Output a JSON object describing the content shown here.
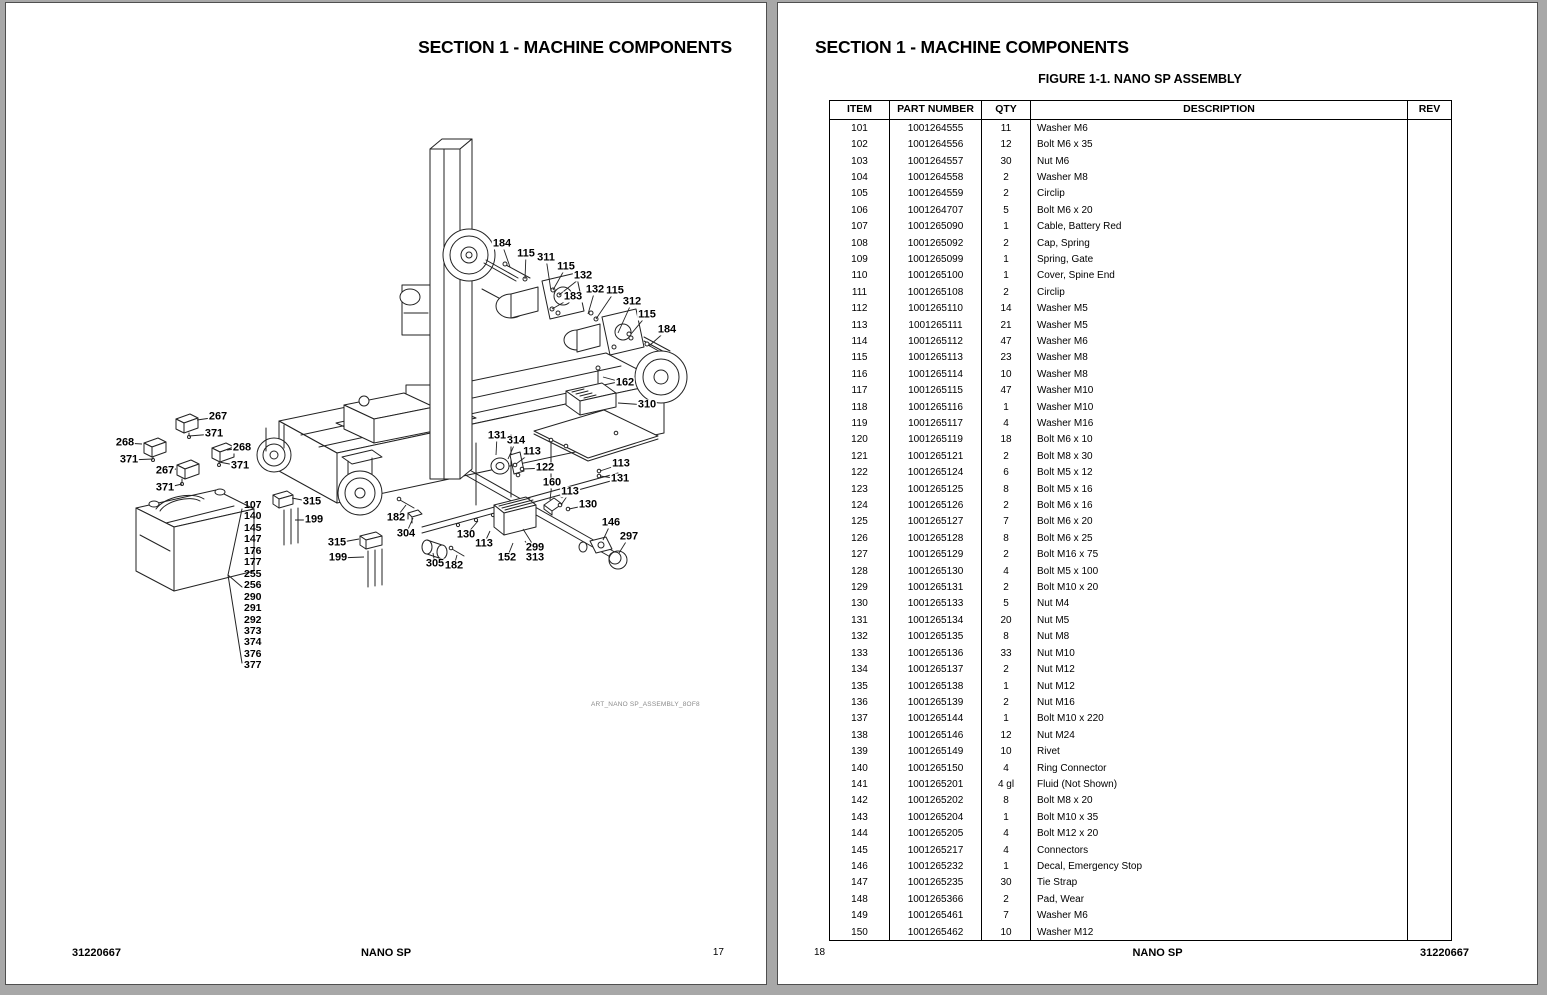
{
  "viewer": {
    "background_color": "#a8a8a8",
    "page_color": "#ffffff"
  },
  "left_page": {
    "section_title": "SECTION 1 - MACHINE COMPONENTS",
    "diagram_caption": "ART_NANO SP_ASSEMBLY_8OF8",
    "footer": {
      "left": "31220667",
      "center": "NANO SP",
      "right": "17"
    },
    "diagram": {
      "callouts": [
        {
          "t": "184",
          "x": 496,
          "y": 241,
          "tx": 504,
          "ty": 264
        },
        {
          "t": "115",
          "x": 520,
          "y": 251,
          "tx": 519,
          "ty": 276
        },
        {
          "t": "311",
          "x": 540,
          "y": 255,
          "tx": 545,
          "ty": 288
        },
        {
          "t": "115",
          "x": 560,
          "y": 264,
          "tx": 547,
          "ty": 287
        },
        {
          "t": "132",
          "x": 577,
          "y": 273,
          "tx": 553,
          "ty": 292
        },
        {
          "t": "183",
          "x": 567,
          "y": 294,
          "tx": 546,
          "ty": 306
        },
        {
          "t": "132",
          "x": 589,
          "y": 287,
          "tx": 582,
          "ty": 311
        },
        {
          "t": "115",
          "x": 609,
          "y": 288,
          "tx": 590,
          "ty": 316
        },
        {
          "t": "312",
          "x": 626,
          "y": 299,
          "tx": 612,
          "ty": 330
        },
        {
          "t": "115",
          "x": 641,
          "y": 312,
          "tx": 625,
          "ty": 331
        },
        {
          "t": "184",
          "x": 661,
          "y": 327,
          "tx": 643,
          "ty": 343
        },
        {
          "t": "162",
          "x": 619,
          "y": 380,
          "tx": 597,
          "ty": 374
        },
        {
          "t": "310",
          "x": 641,
          "y": 402,
          "tx": 612,
          "ty": 400
        },
        {
          "t": "267",
          "x": 212,
          "y": 414,
          "tx": 191,
          "ty": 417
        },
        {
          "t": "371",
          "x": 208,
          "y": 431,
          "tx": 183,
          "ty": 433
        },
        {
          "t": "268",
          "x": 119,
          "y": 440,
          "tx": 136,
          "ty": 441
        },
        {
          "t": "371",
          "x": 123,
          "y": 457,
          "tx": 147,
          "ty": 456
        },
        {
          "t": "268",
          "x": 236,
          "y": 445,
          "tx": 221,
          "ty": 447
        },
        {
          "t": "371",
          "x": 234,
          "y": 463,
          "tx": 213,
          "ty": 459
        },
        {
          "t": "267",
          "x": 159,
          "y": 468,
          "tx": 170,
          "ty": 466
        },
        {
          "t": "371",
          "x": 159,
          "y": 485,
          "tx": 176,
          "ty": 481
        },
        {
          "t": "315",
          "x": 306,
          "y": 499,
          "tx": 286,
          "ty": 495
        },
        {
          "t": "199",
          "x": 308,
          "y": 517,
          "tx": 289,
          "ty": 517
        },
        {
          "t": "182",
          "x": 390,
          "y": 515,
          "tx": 400,
          "ty": 502
        },
        {
          "t": "304",
          "x": 400,
          "y": 531,
          "tx": 407,
          "ty": 515
        },
        {
          "t": "315",
          "x": 331,
          "y": 540,
          "tx": 353,
          "ty": 536
        },
        {
          "t": "199",
          "x": 332,
          "y": 555,
          "tx": 358,
          "ty": 554
        },
        {
          "t": "305",
          "x": 429,
          "y": 561,
          "tx": 427,
          "ty": 550
        },
        {
          "t": "182",
          "x": 448,
          "y": 563,
          "tx": 451,
          "ty": 552
        },
        {
          "t": "130",
          "x": 460,
          "y": 532,
          "tx": 472,
          "ty": 518
        },
        {
          "t": "113",
          "x": 478,
          "y": 541,
          "tx": 484,
          "ty": 528
        },
        {
          "t": "152",
          "x": 501,
          "y": 555,
          "tx": 507,
          "ty": 540
        },
        {
          "t": "299",
          "x": 529,
          "y": 545,
          "tx": 517,
          "ty": 526
        },
        {
          "t": "313",
          "x": 529,
          "y": 555,
          "tx": 519,
          "ty": 538
        },
        {
          "t": "131",
          "x": 491,
          "y": 433,
          "tx": 490,
          "ty": 452
        },
        {
          "t": "314",
          "x": 510,
          "y": 438,
          "tx": 502,
          "ty": 456
        },
        {
          "t": "113",
          "x": 526,
          "y": 449,
          "tx": 510,
          "ty": 461
        },
        {
          "t": "122",
          "x": 539,
          "y": 465,
          "tx": 517,
          "ty": 466
        },
        {
          "t": "113",
          "x": 615,
          "y": 461,
          "tx": 594,
          "ty": 468
        },
        {
          "t": "131",
          "x": 614,
          "y": 476,
          "tx": 594,
          "ty": 473
        },
        {
          "t": "160",
          "x": 546,
          "y": 480,
          "tx": 544,
          "ty": 497
        },
        {
          "t": "113",
          "x": 564,
          "y": 489,
          "tx": 555,
          "ty": 502
        },
        {
          "t": "130",
          "x": 582,
          "y": 502,
          "tx": 563,
          "ty": 506
        },
        {
          "t": "146",
          "x": 605,
          "y": 520,
          "tx": 597,
          "ty": 537
        },
        {
          "t": "297",
          "x": 623,
          "y": 534,
          "tx": 613,
          "ty": 550
        }
      ],
      "battery_ref_items": [
        "107",
        "140",
        "145",
        "147",
        "176",
        "177",
        "255",
        "256",
        "290",
        "291",
        "292",
        "373",
        "374",
        "376",
        "377"
      ]
    }
  },
  "right_page": {
    "section_title": "SECTION 1 - MACHINE COMPONENTS",
    "figure_title": "FIGURE 1-1. NANO SP ASSEMBLY",
    "footer": {
      "left": "18",
      "center": "NANO SP",
      "right": "31220667"
    },
    "table": {
      "columns": [
        "ITEM",
        "PART NUMBER",
        "QTY",
        "DESCRIPTION",
        "REV"
      ],
      "rows": [
        [
          "101",
          "1001264555",
          "11",
          "Washer M6",
          ""
        ],
        [
          "102",
          "1001264556",
          "12",
          "Bolt M6 x 35",
          ""
        ],
        [
          "103",
          "1001264557",
          "30",
          "Nut M6",
          ""
        ],
        [
          "104",
          "1001264558",
          "2",
          "Washer M8",
          ""
        ],
        [
          "105",
          "1001264559",
          "2",
          "Circlip",
          ""
        ],
        [
          "106",
          "1001264707",
          "5",
          "Bolt M6 x 20",
          ""
        ],
        [
          "107",
          "1001265090",
          "1",
          "Cable, Battery Red",
          ""
        ],
        [
          "108",
          "1001265092",
          "2",
          "Cap, Spring",
          ""
        ],
        [
          "109",
          "1001265099",
          "1",
          "Spring, Gate",
          ""
        ],
        [
          "110",
          "1001265100",
          "1",
          "Cover, Spine End",
          ""
        ],
        [
          "111",
          "1001265108",
          "2",
          "Circlip",
          ""
        ],
        [
          "112",
          "1001265110",
          "14",
          "Washer M5",
          ""
        ],
        [
          "113",
          "1001265111",
          "21",
          "Washer M5",
          ""
        ],
        [
          "114",
          "1001265112",
          "47",
          "Washer M6",
          ""
        ],
        [
          "115",
          "1001265113",
          "23",
          "Washer M8",
          ""
        ],
        [
          "116",
          "1001265114",
          "10",
          "Washer M8",
          ""
        ],
        [
          "117",
          "1001265115",
          "47",
          "Washer M10",
          ""
        ],
        [
          "118",
          "1001265116",
          "1",
          "Washer M10",
          ""
        ],
        [
          "119",
          "1001265117",
          "4",
          "Washer M16",
          ""
        ],
        [
          "120",
          "1001265119",
          "18",
          "Bolt M6 x 10",
          ""
        ],
        [
          "121",
          "1001265121",
          "2",
          "Bolt M8 x 30",
          ""
        ],
        [
          "122",
          "1001265124",
          "6",
          "Bolt M5 x 12",
          ""
        ],
        [
          "123",
          "1001265125",
          "8",
          "Bolt M5 x 16",
          ""
        ],
        [
          "124",
          "1001265126",
          "2",
          "Bolt M6 x 16",
          ""
        ],
        [
          "125",
          "1001265127",
          "7",
          "Bolt M6 x 20",
          ""
        ],
        [
          "126",
          "1001265128",
          "8",
          "Bolt M6 x 25",
          ""
        ],
        [
          "127",
          "1001265129",
          "2",
          "Bolt M16 x 75",
          ""
        ],
        [
          "128",
          "1001265130",
          "4",
          "Bolt M5 x 100",
          ""
        ],
        [
          "129",
          "1001265131",
          "2",
          "Bolt M10 x 20",
          ""
        ],
        [
          "130",
          "1001265133",
          "5",
          "Nut M4",
          ""
        ],
        [
          "131",
          "1001265134",
          "20",
          "Nut M5",
          ""
        ],
        [
          "132",
          "1001265135",
          "8",
          "Nut M8",
          ""
        ],
        [
          "133",
          "1001265136",
          "33",
          "Nut M10",
          ""
        ],
        [
          "134",
          "1001265137",
          "2",
          "Nut M12",
          ""
        ],
        [
          "135",
          "1001265138",
          "1",
          "Nut M12",
          ""
        ],
        [
          "136",
          "1001265139",
          "2",
          "Nut M16",
          ""
        ],
        [
          "137",
          "1001265144",
          "1",
          "Bolt M10 x 220",
          ""
        ],
        [
          "138",
          "1001265146",
          "12",
          "Nut M24",
          ""
        ],
        [
          "139",
          "1001265149",
          "10",
          "Rivet",
          ""
        ],
        [
          "140",
          "1001265150",
          "4",
          "Ring Connector",
          ""
        ],
        [
          "141",
          "1001265201",
          "4 gl",
          "Fluid (Not Shown)",
          ""
        ],
        [
          "142",
          "1001265202",
          "8",
          "Bolt M8 x 20",
          ""
        ],
        [
          "143",
          "1001265204",
          "1",
          "Bolt M10 x 35",
          ""
        ],
        [
          "144",
          "1001265205",
          "4",
          "Bolt M12 x 20",
          ""
        ],
        [
          "145",
          "1001265217",
          "4",
          "Connectors",
          ""
        ],
        [
          "146",
          "1001265232",
          "1",
          "Decal, Emergency Stop",
          ""
        ],
        [
          "147",
          "1001265235",
          "30",
          "Tie Strap",
          ""
        ],
        [
          "148",
          "1001265366",
          "2",
          "Pad, Wear",
          ""
        ],
        [
          "149",
          "1001265461",
          "7",
          "Washer M6",
          ""
        ],
        [
          "150",
          "1001265462",
          "10",
          "Washer M12",
          ""
        ]
      ]
    }
  }
}
